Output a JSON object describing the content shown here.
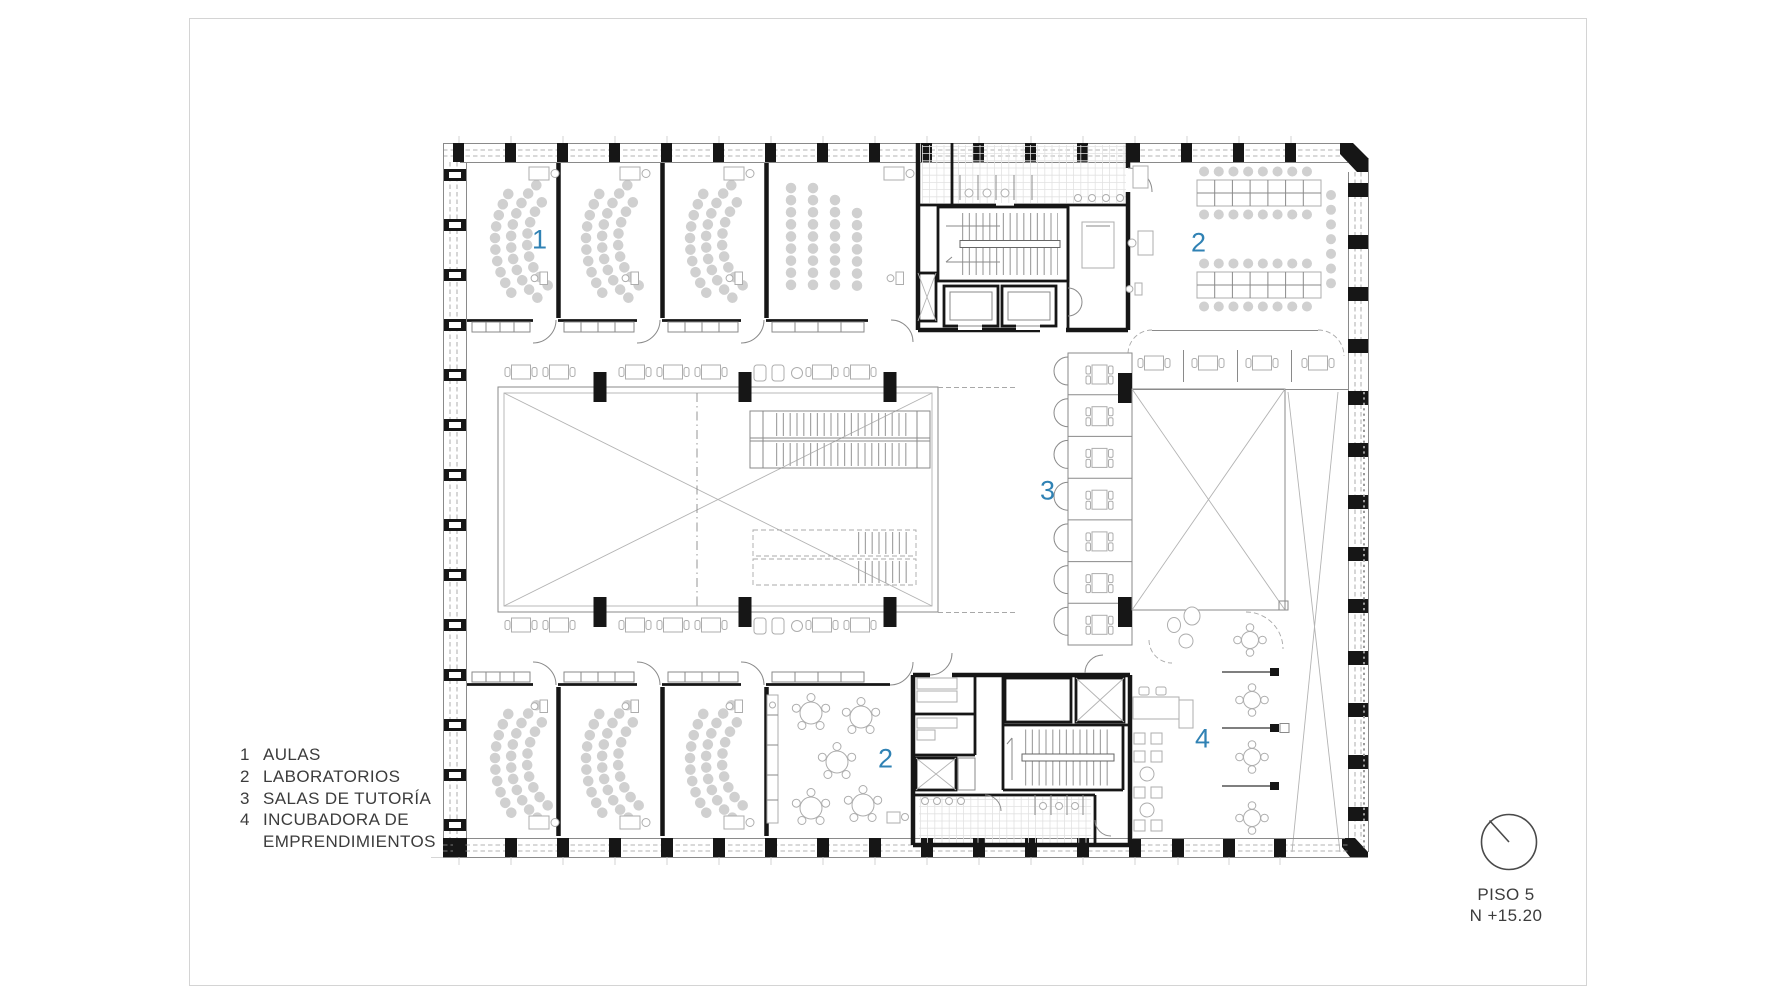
{
  "page": {
    "background": "#ffffff",
    "frame_color": "#d4d4d4",
    "ink_color": "#3c3c3c",
    "accent_color": "#3082b4"
  },
  "legend": {
    "items": [
      {
        "number": "1",
        "label": "AULAS"
      },
      {
        "number": "2",
        "label": "LABORATORIOS"
      },
      {
        "number": "3",
        "label": "SALAS DE TUTORÍA"
      },
      {
        "number": "4",
        "label": "INCUBADORA DE\nEMPRENDIMIENTOS"
      }
    ]
  },
  "title_block": {
    "floor": "PISO 5",
    "level": "N +15.20"
  },
  "plan": {
    "room_labels": [
      {
        "room": "aulas",
        "text": "1"
      },
      {
        "room": "laboratorio-norte",
        "text": "2"
      },
      {
        "room": "salas-de-tutoria",
        "text": "3"
      },
      {
        "room": "laboratorio-sur",
        "text": "2"
      },
      {
        "room": "incubadora-de-emprendimientos",
        "text": "4"
      }
    ]
  }
}
